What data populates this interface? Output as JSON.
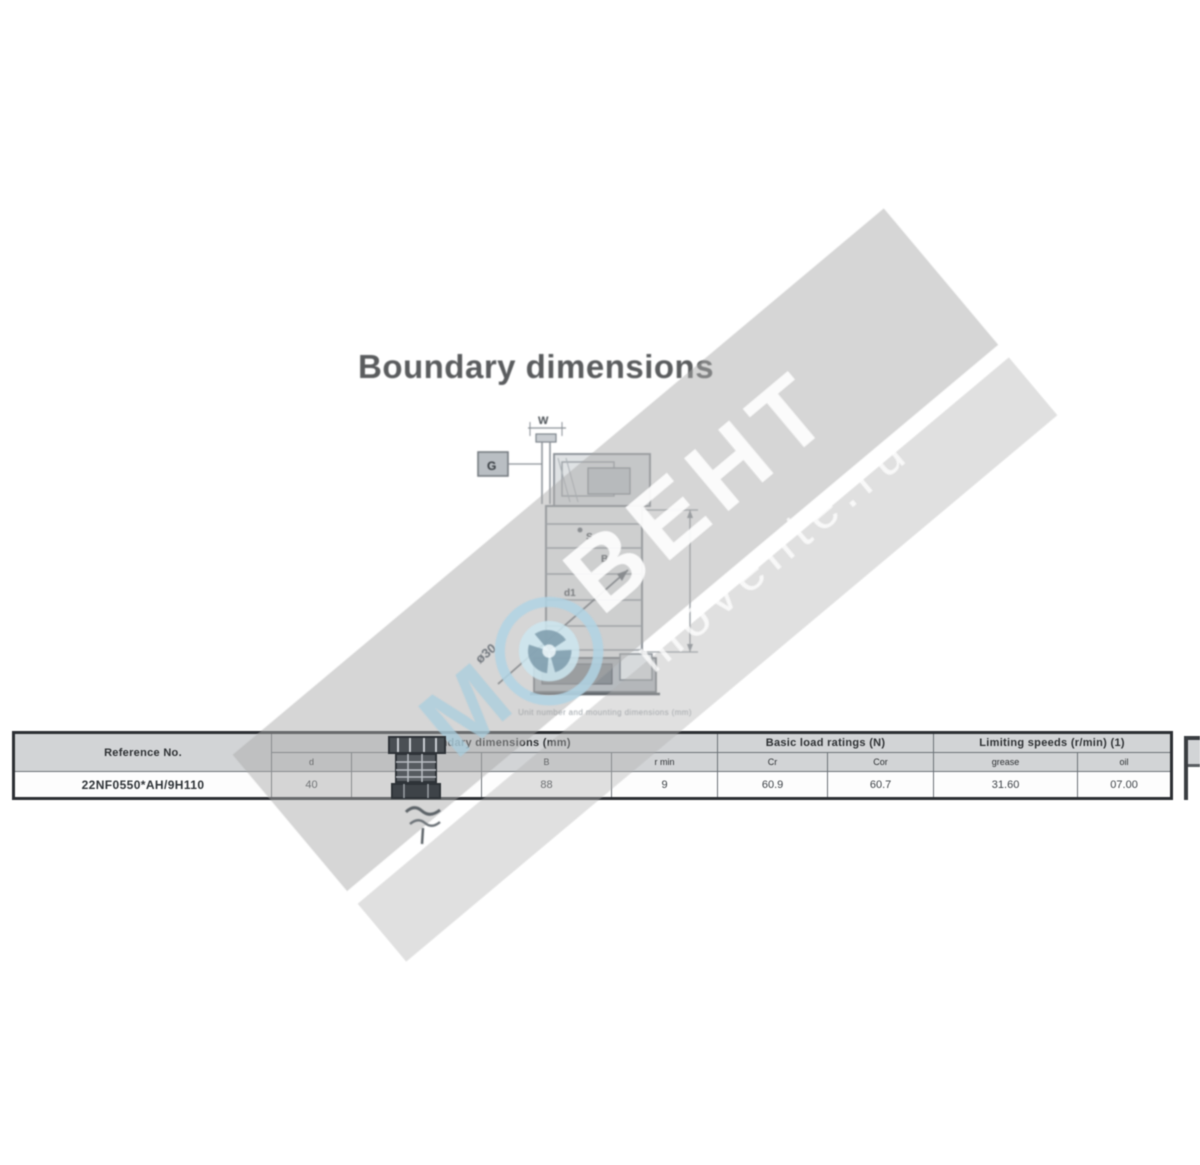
{
  "page": {
    "title": "Boundary dimensions",
    "caption": "Unit number and mounting dimensions (mm)"
  },
  "watermark": {
    "brand_prefix": "М",
    "brand": "ВЕНТ",
    "site": "movente.ru",
    "band_color": "#cfcfcf",
    "accent_color": "#bcd9e6",
    "logo_icon": "fan-logo-icon"
  },
  "drawing": {
    "labels": {
      "top_width": "W",
      "left_block": "G",
      "inner_s": "S",
      "inner_b": "B",
      "inner_d1": "d1",
      "bore": "ø30"
    }
  },
  "table": {
    "groups": [
      {
        "label": "Reference No."
      },
      {
        "label": "Boundary dimensions (mm)"
      },
      {
        "label": "Basic load ratings (N)"
      },
      {
        "label": "Limiting speeds (r/min) (1)"
      }
    ],
    "sub_headers": [
      "d",
      "D",
      "B",
      "r min",
      "Cr",
      "Cor",
      "grease",
      "oil"
    ],
    "row": {
      "reference": "22NF0550*AH/9H110",
      "d": "40",
      "D": "",
      "B": "88",
      "r": "9",
      "cr": "60.9",
      "cor": "60.7",
      "grease": "31.60",
      "oil": "07.00"
    }
  }
}
